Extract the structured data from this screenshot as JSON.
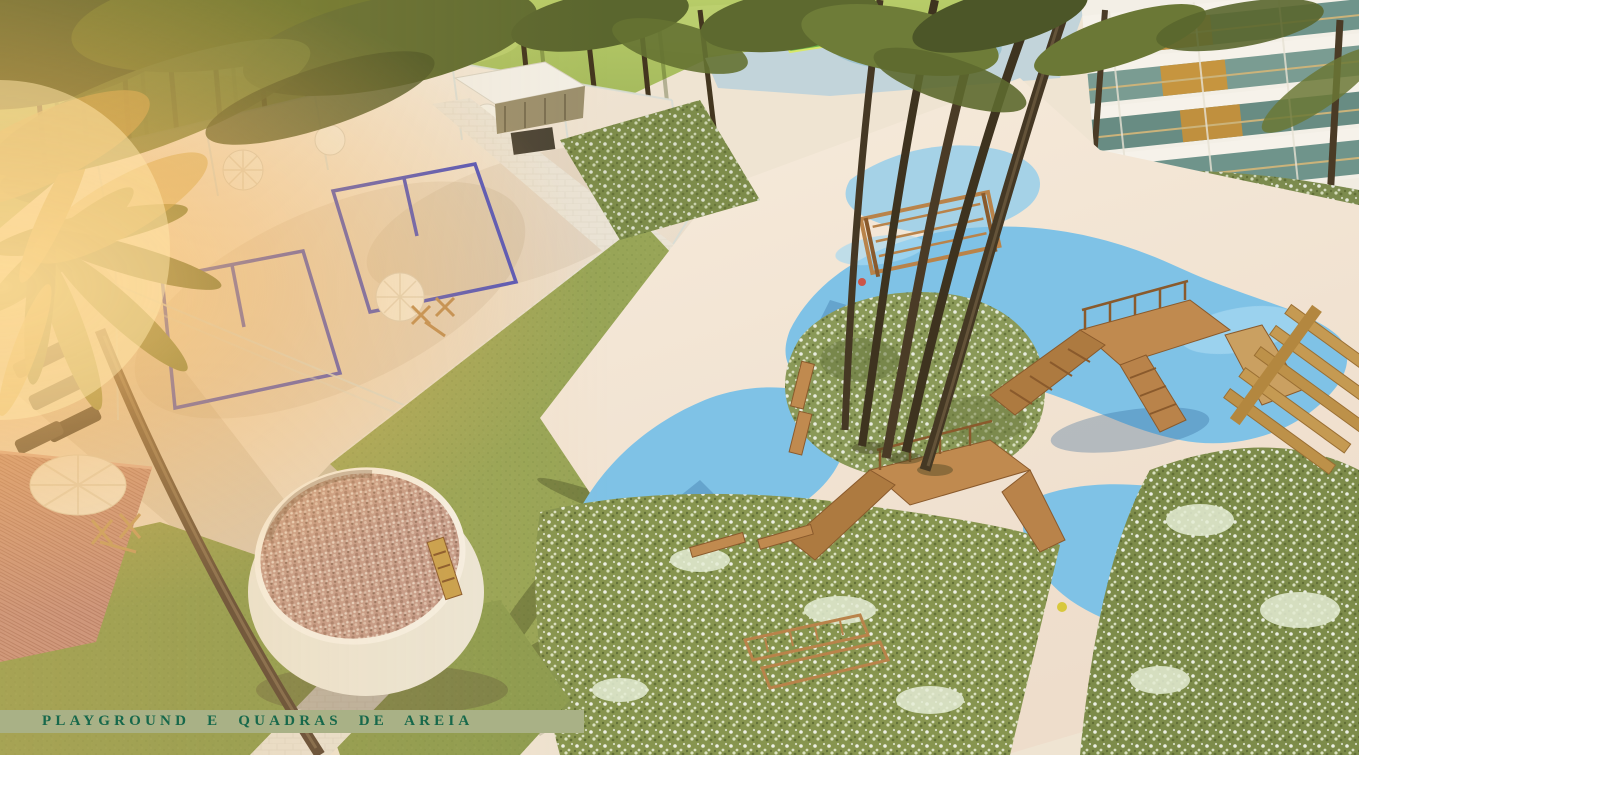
{
  "page": {
    "background": "#ffffff"
  },
  "render": {
    "kind": "aerial-architectural-rendering",
    "subject": "condominium leisure area: playground and beach sand courts",
    "width_px": 1359,
    "height_px": 755
  },
  "caption": {
    "text": "PLAYGROUND E QUADRAS DE AREIA"
  },
  "palette": {
    "page_bg": "#ffffff",
    "banner_bg": "#a9b186",
    "banner_text": "#17684b",
    "sand": "#f2e7d7",
    "sand_shadow": "#d6c5b2",
    "court_line": "#4a4fc0",
    "lawn_top": "#a9c05e",
    "grass": "#97a456",
    "shrub": "#7d8c4a",
    "shrub_flower": "#e9efdb",
    "play_blue": "#7fc2e6",
    "play_blue_shadow": "#5c9ed0",
    "wood": "#b9834a",
    "wood_dark": "#8a5a2c",
    "palm_trunk": "#3e331f",
    "palm_frond": "#66732f",
    "building_slab": "#f3efe6",
    "building_glass": "#6f948b",
    "building_wood": "#c0903e",
    "pebble_fill": "#c49b8b",
    "deck_pink": "#c58e82",
    "umbrella": "#f3efe3",
    "sun_flare": "#f6b55e"
  },
  "scene": {
    "elements": [
      {
        "name": "top-lawn-palm-grove",
        "label": "sunlit lawn with palm grove"
      },
      {
        "name": "aquatic-play-area",
        "label": "aquatic play deck"
      },
      {
        "name": "apartment-building",
        "label": "residential building facade"
      },
      {
        "name": "beach-tennis-courts",
        "label": "two fenced beach tennis sand courts"
      },
      {
        "name": "central-lawn",
        "label": "mowed lawn diamond"
      },
      {
        "name": "walkways",
        "label": "paver walkways"
      },
      {
        "name": "playground-surface",
        "label": "blue rubber playground surface"
      },
      {
        "name": "playground-equipment",
        "label": "timber play structures"
      },
      {
        "name": "pebble-pit",
        "label": "raised circular pebble pit"
      },
      {
        "name": "timber-deck",
        "label": "rose timber deck"
      },
      {
        "name": "flowering-shrubs",
        "label": "flowering shrub masses"
      },
      {
        "name": "palms",
        "label": "coconut palms"
      },
      {
        "name": "caption-banner",
        "label": "title banner"
      }
    ]
  }
}
